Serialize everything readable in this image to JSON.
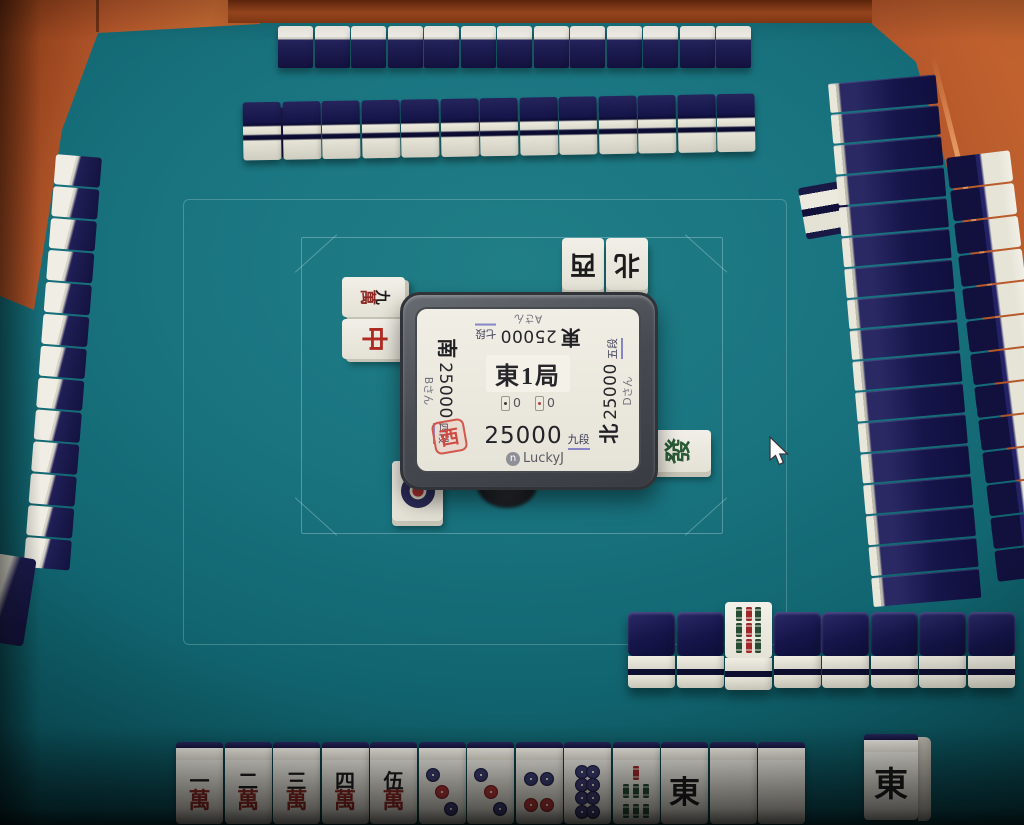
{
  "game": {
    "client_cursor": "arrow",
    "colors": {
      "felt": "#197480",
      "tile_back_navy": "#14133f",
      "tile_face": "#ece9de",
      "frame_orange": "#b5572b",
      "stamp_red": "#cf4a42",
      "rank_underline": "#8585c8",
      "man_red": "#8d2822",
      "sou_green": "#274a32",
      "pin_blue": "#3c3c72",
      "pin_red": "#b03636"
    }
  },
  "center_display": {
    "round": "東1局",
    "honba_count": "0",
    "riichi_count": "0",
    "players": {
      "top": {
        "wind": "東",
        "score": "25000",
        "rank": "七段",
        "name": "Aさん"
      },
      "left": {
        "wind": "南",
        "score": "25000",
        "rank": "四段",
        "name": "Bさん"
      },
      "right": {
        "wind": "北",
        "score": "25000",
        "rank": "五段",
        "name": "Dさん"
      },
      "bottom": {
        "seat_stamp": "西",
        "score": "25000",
        "rank": "九段",
        "badge": "n",
        "name": "LuckyJ"
      }
    }
  },
  "tiles": {
    "man_suffix": "萬",
    "m1": {
      "suit": "man",
      "num": "一"
    },
    "m2": {
      "suit": "man",
      "num": "二"
    },
    "m3": {
      "suit": "man",
      "num": "三"
    },
    "m4": {
      "suit": "man",
      "num": "四"
    },
    "m5": {
      "suit": "man",
      "num": "伍"
    },
    "m9": {
      "suit": "man",
      "num": "九"
    },
    "p1": {
      "suit": "pin",
      "value": 1
    },
    "p3": {
      "suit": "pin",
      "value": 3
    },
    "p4": {
      "suit": "pin",
      "value": 4
    },
    "p8": {
      "suit": "pin",
      "value": 8
    },
    "s7": {
      "suit": "sou",
      "value": 7
    },
    "s9": {
      "suit": "sou",
      "value": 9
    },
    "E": {
      "suit": "honor",
      "char": "東",
      "ink": "#1c1c1c"
    },
    "W": {
      "suit": "honor",
      "char": "西",
      "ink": "#1c1c1c"
    },
    "N": {
      "suit": "honor",
      "char": "北",
      "ink": "#1c1c1c"
    },
    "C": {
      "suit": "honor",
      "char": "中",
      "ink": "#b02a22"
    },
    "F": {
      "suit": "honor",
      "char": "發",
      "ink": "#2a5a36"
    },
    "haku": {
      "suit": "blank"
    }
  },
  "hands": {
    "bottom": {
      "tiles": [
        "m1",
        "m2",
        "m3",
        "m4",
        "m5",
        "p3",
        "p3",
        "p4",
        "p8",
        "s7",
        "E",
        "haku",
        "haku"
      ],
      "drawn": "E"
    },
    "top": {
      "count": 13
    },
    "left": {
      "count": 13
    },
    "right": {
      "count": 13
    }
  },
  "walls": {
    "top": {
      "count": 13
    },
    "right": {
      "count": 17
    },
    "dead": {
      "count": 8,
      "dora_index": 2,
      "dora_tile": "s9"
    }
  },
  "discards": {
    "top": {
      "owner": "east-player",
      "tiles": [
        "W",
        "N"
      ]
    },
    "left": {
      "owner": "south-player",
      "tiles": [
        "m9",
        "C"
      ]
    },
    "right": {
      "owner": "north-player",
      "tiles": [
        "F"
      ]
    },
    "bottom": {
      "owner": "west-player",
      "tiles": [
        "p1"
      ]
    }
  }
}
